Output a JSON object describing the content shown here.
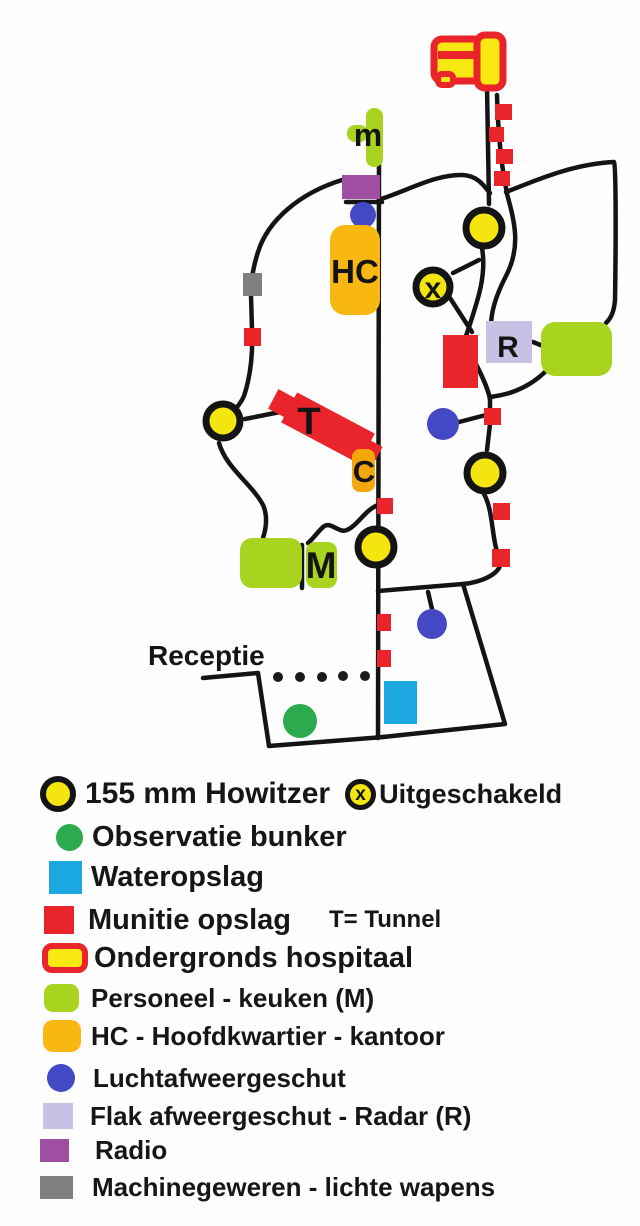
{
  "map": {
    "labels": {
      "kitchen_small": "m",
      "headquarters": "HC",
      "disabled_howitzer": "x",
      "radar": "R",
      "tunnel": "T",
      "canteen": "C",
      "kitchen": "M",
      "reception": "Receptie"
    }
  },
  "legend": {
    "howitzer": "155 mm Howitzer",
    "disabled_symbol": "x",
    "disabled": "Uitgeschakeld",
    "observation": "Observatie bunker",
    "water": "Wateropslag",
    "munition": "Munitie opslag",
    "tunnel_note": "T= Tunnel",
    "hospital": "Ondergronds hospitaal",
    "personnel": "Personeel - keuken (M)",
    "headquarters": "HC - Hoofdkwartier - kantoor",
    "antiaircraft": "Luchtafweergeschut",
    "flak": "Flak afweergeschut - Radar (R)",
    "radio": "Radio",
    "machineguns": "Machinegeweren - lichte wapens"
  },
  "colors": {
    "howitzer_yellow": "#f4e511",
    "outline_black": "#141414",
    "munition_red": "#e9242b",
    "observation_green": "#2bab4d",
    "water_blue": "#1ba7e0",
    "personnel_green": "#a8d41f",
    "hq_orange": "#f8b711",
    "aa_blue": "#4348c4",
    "flak_lavender": "#c9c0e6",
    "radio_purple": "#a04ea2",
    "mg_gray": "#7f7f7f"
  }
}
